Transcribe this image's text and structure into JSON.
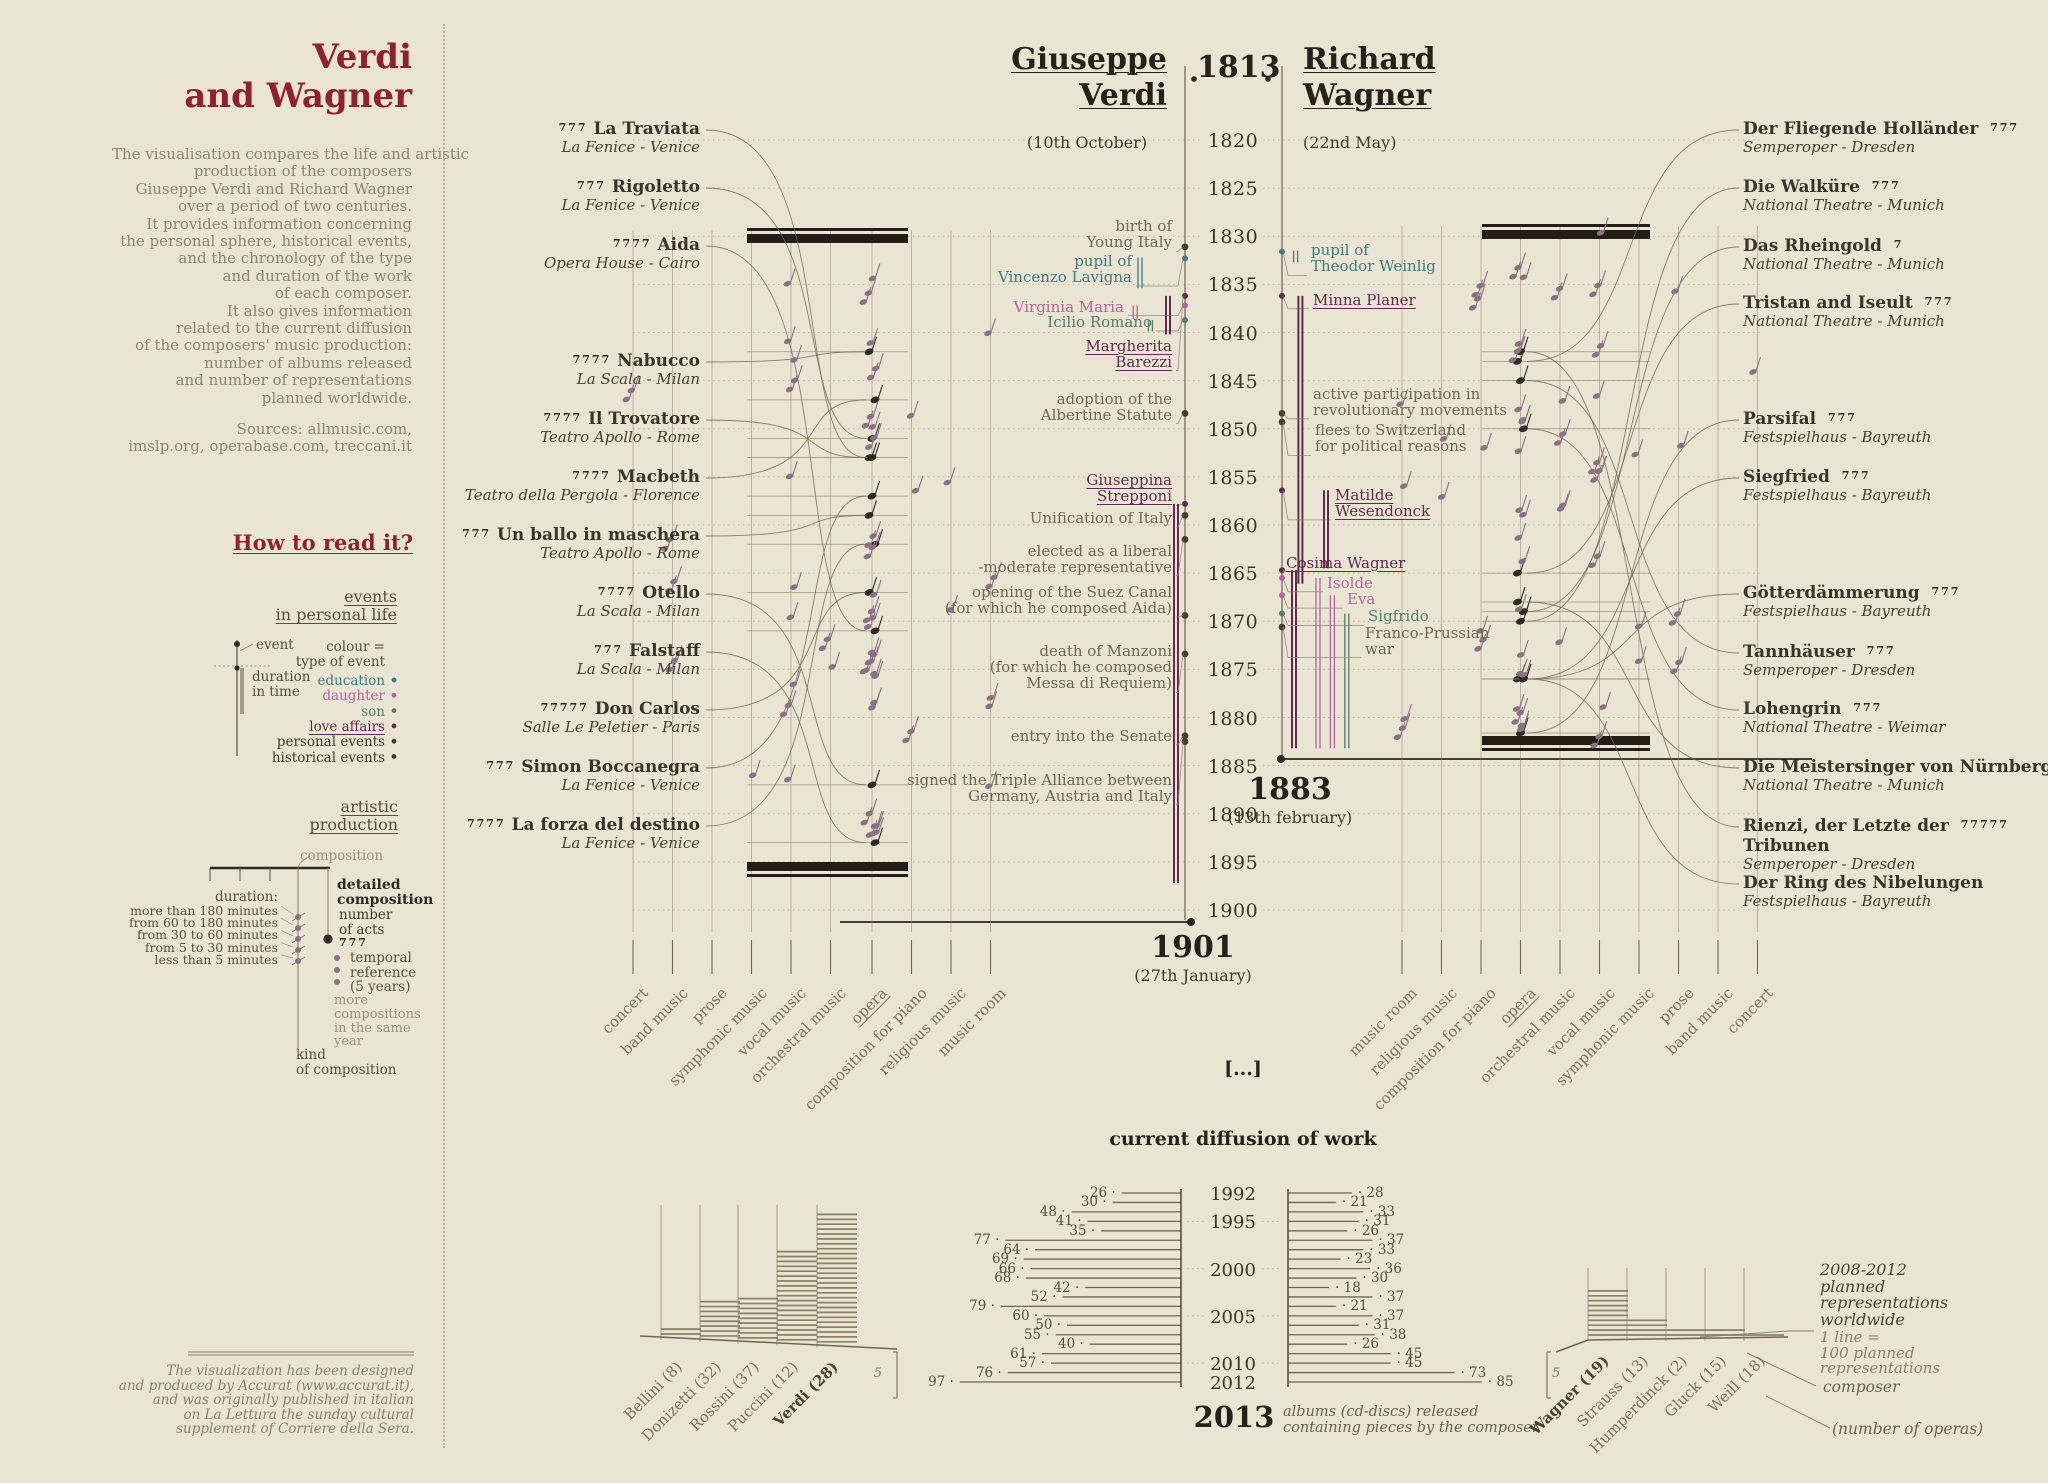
{
  "colors": {
    "accent_red": "#8e2134",
    "background": "#e9e5d2",
    "ink": "#3a342a",
    "muted": "#8d8573",
    "event_gray": "#6f6756",
    "plum": "#5f2b4f",
    "teal": "#3f7d81",
    "orchid": "#b066a3",
    "green": "#55806d",
    "note": "#8c7184",
    "line_brown": "#6f6553",
    "black_bar": "#221d15"
  },
  "sidebar": {
    "title1": "Verdi",
    "title2": "and Wagner",
    "intro": [
      "The visualisation compares the life and artistic",
      "production of the composers",
      "Giuseppe Verdi and Richard Wagner",
      "over a period of two centuries.",
      "It provides information concerning",
      "the personal sphere, historical events,",
      "and the chronology of the type",
      "and duration of the work",
      "of each composer.",
      "It also gives information",
      "related to the current diffusion",
      "of the composers' music production:",
      "number of albums released",
      "and number of representations",
      "planned worldwide."
    ],
    "sources": [
      "Sources: allmusic.com,",
      "imslp.org, operabase.com, treccani.it"
    ],
    "how_to_read": "How to read it?",
    "events_legend": {
      "heading1": "events",
      "heading2": "in personal life",
      "event_label": "event",
      "duration_label": [
        "duration",
        "in time"
      ],
      "colour_label": [
        "colour =",
        "type of event"
      ],
      "types": [
        {
          "label": "education",
          "color": "#3f7d81"
        },
        {
          "label": "daughter",
          "color": "#b066a3"
        },
        {
          "label": "son",
          "color": "#55806d"
        },
        {
          "label": "love affairs",
          "color": "#5f2b4f",
          "underline": true
        },
        {
          "label": "personal events",
          "color": "#3f3a2e"
        },
        {
          "label": "historical events",
          "color": "#3f3a2e"
        }
      ]
    },
    "production_legend": {
      "heading1": "artistic",
      "heading2": "production",
      "composition": "composition",
      "duration_title": "duration:",
      "durations": [
        "more than 180 minutes",
        "from 60 to 180 minutes",
        "from 30 to 60 minutes",
        "from 5 to 30 minutes",
        "less than 5 minutes"
      ],
      "detailed": [
        "detailed",
        "composition"
      ],
      "acts": [
        "number",
        "of acts"
      ],
      "acts_glyph": "777",
      "temporal": [
        "temporal",
        "reference",
        "(5 years)"
      ],
      "more": [
        "more",
        "compositions",
        "in the same",
        "year"
      ],
      "kind": [
        "kind",
        "of composition"
      ]
    },
    "footer": [
      "The visualization has been designed",
      "and produced by Accurat (www.accurat.it),",
      "and was originally published in italian",
      "on La Lettura the sunday cultural",
      "supplement of Corriere della Sera."
    ]
  },
  "header": {
    "left1": "Giuseppe",
    "left2": "Verdi",
    "year": "1813",
    "right1": "Richard",
    "right2": "Wagner",
    "left_date": "(10th October)",
    "right_date": "(22nd May)"
  },
  "timeline": {
    "start": 1820,
    "end": 1900,
    "step": 5,
    "verdi_death": {
      "year": "1901",
      "date": "(27th January)"
    },
    "wagner_death": {
      "year": "1883",
      "date": "(13th february)"
    }
  },
  "verdi": {
    "categories": [
      "concert",
      "band music",
      "prose",
      "symphonic music",
      "vocal music",
      "orchestral music",
      "opera",
      "composition for piano",
      "religious music",
      "music room"
    ],
    "opera_underline_index": 6,
    "operas": [
      {
        "name": "La Traviata",
        "venue": "La Fenice - Venice",
        "acts": 3,
        "premiere": 1853
      },
      {
        "name": "Rigoletto",
        "venue": "La Fenice - Venice",
        "acts": 3,
        "premiere": 1851
      },
      {
        "name": "Aida",
        "venue": "Opera House - Cairo",
        "acts": 4,
        "premiere": 1871
      },
      {
        "name": "Nabucco",
        "venue": "La Scala - Milan",
        "acts": 4,
        "premiere": 1842
      },
      {
        "name": "Il Trovatore",
        "venue": "Teatro Apollo - Rome",
        "acts": 4,
        "premiere": 1853
      },
      {
        "name": "Macbeth",
        "venue": "Teatro della Pergola - Florence",
        "acts": 4,
        "premiere": 1847
      },
      {
        "name": "Un ballo in maschera",
        "venue": "Teatro Apollo - Rome",
        "acts": 3,
        "premiere": 1859
      },
      {
        "name": "Otello",
        "venue": "La Scala - Milan",
        "acts": 4,
        "premiere": 1887
      },
      {
        "name": "Falstaff",
        "venue": "La Scala - Milan",
        "acts": 3,
        "premiere": 1893
      },
      {
        "name": "Don Carlos",
        "venue": "Salle Le Peletier - Paris",
        "acts": 5,
        "premiere": 1867
      },
      {
        "name": "Simon Boccanegra",
        "venue": "La Fenice - Venice",
        "acts": 3,
        "premiere": 1857
      },
      {
        "name": "La forza del destino",
        "venue": "La Fenice - Venice",
        "acts": 4,
        "premiere": 1862
      }
    ],
    "events": [
      {
        "type": "historical",
        "lines": [
          "birth of",
          "Young Italy"
        ],
        "year": 1829.8,
        "dot": 1831.1
      },
      {
        "type": "education",
        "lines": [
          "pupil of",
          "Vincenzo Lavigna"
        ],
        "year": 1833.4,
        "dot": 1832.3,
        "indent": 40,
        "bar": {
          "from": 1832.2,
          "to": 1835.4,
          "lane": 4.5
        }
      },
      {
        "type": "daughter",
        "lines": [
          "Virginia Maria"
        ],
        "year": 1837.3,
        "dot": 1837.2,
        "indent": 48,
        "bar": {
          "from": 1837.2,
          "to": 1838.6,
          "lane": 5.1
        }
      },
      {
        "type": "son",
        "lines": [
          "Icilio Romano"
        ],
        "year": 1838.9,
        "dot": 1838.7,
        "indent": 20,
        "bar": {
          "from": 1838.7,
          "to": 1839.9,
          "lane": 3.2
        }
      },
      {
        "type": "love",
        "underline": true,
        "lines": [
          "Margherita",
          "Barezzi"
        ],
        "year": 1842.2,
        "dot": 1836.2,
        "bar": {
          "from": 1836.2,
          "to": 1840.2,
          "lane": 1
        }
      },
      {
        "type": "historical",
        "lines": [
          "adoption of the",
          "Albertine Statute"
        ],
        "year": 1847.7,
        "dot": 1848.4
      },
      {
        "type": "love",
        "underline": true,
        "lines": [
          "Giuseppina",
          "Strepponi"
        ],
        "year": 1856.2,
        "dot": 1857.8,
        "bar": {
          "from": 1857.8,
          "to": 1897.2,
          "lane": 0
        }
      },
      {
        "type": "historical",
        "lines": [
          "Unification of Italy"
        ],
        "year": 1859.3,
        "dot": 1859
      },
      {
        "type": "personal",
        "lines": [
          "elected as a liberal",
          "-moderate representative"
        ],
        "year": 1863.5,
        "dot": 1861.5
      },
      {
        "type": "historical",
        "lines": [
          "opening of the Suez Canal",
          "(for which he composed Aida)"
        ],
        "year": 1867.8,
        "dot": 1869.4
      },
      {
        "type": "personal",
        "lines": [
          "death of Manzoni",
          "(for which he composed",
          "Messa di Requiem)"
        ],
        "year": 1874.8,
        "dot": 1873.4
      },
      {
        "type": "personal",
        "lines": [
          "entry into the Senate"
        ],
        "year": 1881.9,
        "dot": 1881.9
      },
      {
        "type": "historical",
        "lines": [
          "signed the Triple Alliance between",
          "Germany, Austria and Italy"
        ],
        "year": 1887.3,
        "dot": 1882.5
      }
    ]
  },
  "wagner": {
    "categories": [
      "music room",
      "religious music",
      "composition for piano",
      "opera",
      "orchestral music",
      "vocal music",
      "symphonic music",
      "prose",
      "band music",
      "concert"
    ],
    "opera_underline_index": 3,
    "operas": [
      {
        "name": "Der Fliegende Holländer",
        "venue": "Semperoper - Dresden",
        "acts": 3,
        "premiere": 1843
      },
      {
        "name": "Die Walküre",
        "venue": "National Theatre - Munich",
        "acts": 3,
        "premiere": 1870
      },
      {
        "name": "Das Rheingold",
        "venue": "National Theatre - Munich",
        "acts": 1,
        "premiere": 1869
      },
      {
        "name": "Tristan and Iseult",
        "venue": "National Theatre - Munich",
        "acts": 3,
        "premiere": 1865
      },
      {
        "name": "Parsifal",
        "venue": "Festspielhaus - Bayreuth",
        "acts": 3,
        "premiere": 1882
      },
      {
        "name": "Siegfried",
        "venue": "Festspielhaus - Bayreuth",
        "acts": 3,
        "premiere": 1876
      },
      {
        "name": "Götterdämmerung",
        "venue": "Festspielhaus - Bayreuth",
        "acts": 3,
        "premiere": 1876
      },
      {
        "name": "Tannhäuser",
        "venue": "Semperoper - Dresden",
        "acts": 3,
        "premiere": 1845
      },
      {
        "name": "Lohengrin",
        "venue": "National Theatre - Weimar",
        "acts": 3,
        "premiere": 1850
      },
      {
        "name": "Die Meistersinger von Nürnberg",
        "venue": "National Theatre - Munich",
        "acts": 3,
        "premiere": 1868
      },
      {
        "name": "Rienzi, der Letzte der",
        "name2": "Tribunen",
        "venue": "Semperoper - Dresden",
        "acts": 5,
        "premiere": 1842
      },
      {
        "name": "Der Ring des Nibelungen",
        "venue": "Festspielhaus - Bayreuth",
        "acts": 0,
        "premiere": 1876
      }
    ],
    "events": [
      {
        "type": "education",
        "lines": [
          "pupil of",
          "Theodor Weinlig"
        ],
        "year": 1832.3,
        "dot": 1831.6,
        "indent": 1,
        "bar": {
          "from": 1831.5,
          "to": 1832.7,
          "lane": 0.2
        }
      },
      {
        "type": "love",
        "underline": true,
        "lines": [
          "Minna Planer"
        ],
        "year": 1836.6,
        "dot": 1836.2,
        "indent": 3,
        "bar": {
          "from": 1836.2,
          "to": 1866.1,
          "lane": 0.8
        }
      },
      {
        "type": "historical",
        "lines": [
          "active participation in",
          "revolutionary movements"
        ],
        "year": 1847.2,
        "dot": 1848.4,
        "indent": 3
      },
      {
        "type": "historical",
        "lines": [
          "flees to Switzerland",
          "for political reasons"
        ],
        "year": 1851,
        "dot": 1849.3,
        "indent": 5
      },
      {
        "type": "love",
        "underline": true,
        "lines": [
          "Matilde",
          "Wesendonck"
        ],
        "year": 1857.7,
        "dot": 1856.4,
        "indent": 25,
        "bar": {
          "from": 1856.4,
          "to": 1864.5,
          "lane": 4
        }
      },
      {
        "type": "love",
        "underline": true,
        "lines": [
          "Cosima Wagner"
        ],
        "year": 1863.9,
        "dot": 1864.7,
        "indent": -24,
        "bar": {
          "from": 1864.7,
          "to": 1883.2,
          "lane": 0
        }
      },
      {
        "type": "daughter",
        "lines": [
          "Isolde"
        ],
        "year": 1866,
        "dot": 1865.5,
        "indent": 17,
        "bar": {
          "from": 1865.5,
          "to": 1883.2,
          "lane": 3
        }
      },
      {
        "type": "daughter",
        "lines": [
          "Eva"
        ],
        "year": 1867.7,
        "dot": 1867.3,
        "indent": 37,
        "bar": {
          "from": 1867.3,
          "to": 1883.2,
          "lane": 4.8
        }
      },
      {
        "type": "son",
        "lines": [
          "Sigfrido"
        ],
        "year": 1869.5,
        "dot": 1869.2,
        "indent": 58,
        "bar": {
          "from": 1869.2,
          "to": 1883.2,
          "lane": 6.6
        }
      },
      {
        "type": "historical",
        "lines": [
          "Franco-Prussian",
          "war"
        ],
        "year": 1872,
        "dot": 1870.6,
        "indent": 55
      }
    ]
  },
  "diffusion": {
    "heading": "current diffusion of work",
    "ellipsis": "[...]",
    "start_year": 1992,
    "labeled_years": [
      1992,
      1995,
      2000,
      2005,
      2010,
      2012
    ],
    "end_label": "2013",
    "caption1": "albums (cd-discs) released",
    "caption2": "containing pieces by the composer"
  },
  "chart_data": {
    "type": "bar",
    "title": "current diffusion of work",
    "x": [
      1992,
      1993,
      1994,
      1995,
      1996,
      1997,
      1998,
      1999,
      2000,
      2001,
      2002,
      2003,
      2004,
      2005,
      2006,
      2007,
      2008,
      2009,
      2010,
      2011,
      2012
    ],
    "xlabel": "year",
    "ylabel": "albums (cd-discs) released containing pieces by the composer",
    "series": [
      {
        "name": "Verdi albums",
        "values": [
          26,
          30,
          48,
          41,
          35,
          77,
          64,
          69,
          66,
          68,
          42,
          52,
          79,
          60,
          50,
          55,
          40,
          61,
          57,
          76,
          97
        ]
      },
      {
        "name": "Wagner albums",
        "values": [
          28,
          21,
          33,
          31,
          26,
          37,
          33,
          23,
          36,
          30,
          18,
          37,
          21,
          37,
          31,
          38,
          26,
          45,
          45,
          73,
          85
        ]
      }
    ],
    "planned_representations": {
      "note": "2008-2012 planned representations worldwide",
      "unit": "1 line = 100 planned representations",
      "italian_composers": [
        {
          "name": "Bellini",
          "operas": 8,
          "lines": 2
        },
        {
          "name": "Donizetti",
          "operas": 32,
          "lines": 8
        },
        {
          "name": "Rossini",
          "operas": 37,
          "lines": 9
        },
        {
          "name": "Puccini",
          "operas": 12,
          "lines": 19
        },
        {
          "name": "Verdi",
          "operas": 28,
          "lines": 27
        }
      ],
      "german_composers": [
        {
          "name": "Wagner",
          "operas": 19,
          "lines": 10
        },
        {
          "name": "Strauss",
          "operas": 13,
          "lines": 4
        },
        {
          "name": "Humperdinck",
          "operas": 2,
          "lines": 2
        },
        {
          "name": "Gluck",
          "operas": 15,
          "lines": 2
        },
        {
          "name": "Weill",
          "operas": 18,
          "lines": 1
        }
      ]
    }
  },
  "planned_labels": {
    "period": [
      "2008-2012",
      "planned",
      "representations",
      "worldwide"
    ],
    "scale": [
      "1 line =",
      "100 planned",
      "representations"
    ],
    "composer": "composer",
    "number_of_operas": "(number of operas)",
    "bracket": "5"
  }
}
